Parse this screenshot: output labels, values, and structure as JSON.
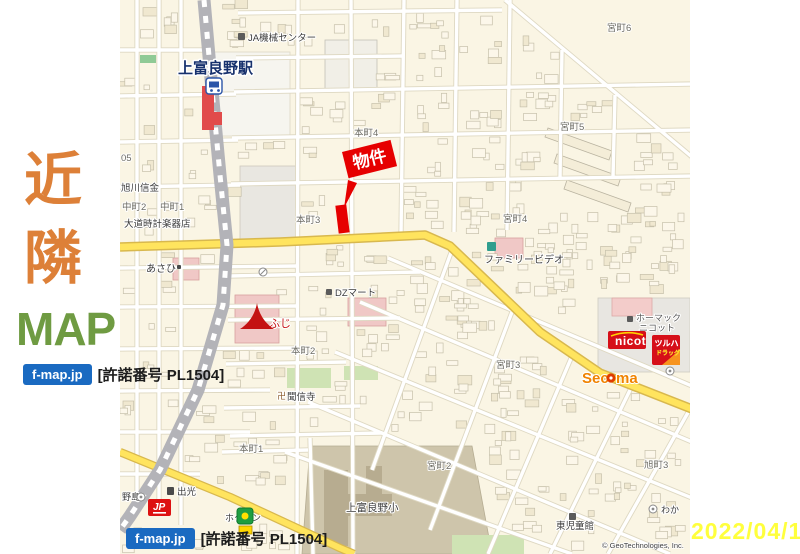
{
  "sidebar": {
    "kanji_top": "近",
    "kanji_bottom": "隣",
    "kanji_color": "#dd8038",
    "word": "MAP",
    "word_color": "#6f9b42",
    "license_badge": "f-map.jp",
    "license_text": "[許諾番号 PL1504]",
    "badge_bg": "#1a6ac1"
  },
  "footer": {
    "license_badge": "f-map.jp",
    "license_text": "[許諾番号 PL1504]"
  },
  "date_stamp": {
    "text": "2022/04/18",
    "color": "#ffff3d"
  },
  "map": {
    "bg": "#faf5e4",
    "copyright": {
      "t": "© GeoTechnologies, Inc.",
      "x": 482,
      "y": 548
    },
    "station": {
      "label": "上富良野駅",
      "x": 58,
      "y": 73,
      "color": "#17316d"
    },
    "banner": {
      "label": "物件",
      "color": "#e60000",
      "x": 222,
      "y": 152,
      "w": 50,
      "h": 27,
      "rot": -14,
      "tail": [
        [
          228,
          180
        ],
        [
          237,
          183
        ],
        [
          224,
          208
        ]
      ],
      "marker": {
        "x": 217,
        "y": 205,
        "w": 11,
        "h": 28,
        "rot": -7
      }
    },
    "roads": {
      "white": [
        [
          17,
          0,
          17,
          505
        ],
        [
          39,
          0,
          39,
          512
        ],
        [
          61,
          0,
          61,
          525
        ],
        [
          0,
          50,
          85,
          50
        ],
        [
          0,
          96,
          116,
          94
        ],
        [
          0,
          142,
          118,
          140
        ],
        [
          0,
          187,
          120,
          185
        ],
        [
          0,
          268,
          178,
          266
        ],
        [
          0,
          307,
          177,
          306
        ],
        [
          0,
          349,
          176,
          348
        ],
        [
          0,
          391,
          150,
          390
        ],
        [
          0,
          432,
          130,
          432
        ],
        [
          0,
          474,
          80,
          474
        ],
        [
          178,
          0,
          177,
          554
        ],
        [
          231,
          0,
          233,
          554
        ],
        [
          284,
          0,
          281,
          234
        ],
        [
          337,
          0,
          334,
          232
        ],
        [
          390,
          0,
          387,
          230
        ],
        [
          442,
          50,
          440,
          178
        ],
        [
          495,
          95,
          493,
          178
        ],
        [
          118,
          13,
          382,
          10
        ],
        [
          116,
          58,
          284,
          56
        ],
        [
          114,
          92,
          572,
          84
        ],
        [
          112,
          138,
          572,
          130
        ],
        [
          111,
          184,
          572,
          176
        ],
        [
          385,
          0,
          572,
          157
        ],
        [
          110,
          276,
          300,
          272
        ],
        [
          108,
          320,
          280,
          318
        ],
        [
          106,
          364,
          226,
          362
        ],
        [
          104,
          408,
          240,
          406
        ],
        [
          102,
          452,
          188,
          450
        ],
        [
          190,
          438,
          193,
          554
        ],
        [
          110,
          436,
          262,
          433
        ],
        [
          268,
          258,
          572,
          386
        ],
        [
          240,
          302,
          572,
          442
        ],
        [
          215,
          352,
          572,
          498
        ],
        [
          188,
          402,
          550,
          554
        ],
        [
          165,
          452,
          452,
          554
        ],
        [
          332,
          250,
          252,
          470
        ],
        [
          392,
          312,
          310,
          530
        ],
        [
          452,
          356,
          368,
          554
        ],
        [
          512,
          386,
          430,
          554
        ],
        [
          570,
          409,
          488,
          554
        ]
      ],
      "yellow_main": [
        [
          0,
          247
        ],
        [
          160,
          242
        ],
        [
          305,
          235
        ],
        [
          330,
          246
        ],
        [
          420,
          332
        ],
        [
          480,
          373
        ],
        [
          572,
          409
        ]
      ],
      "yellow_south": [
        [
          0,
          452
        ],
        [
          110,
          497
        ],
        [
          220,
          548
        ],
        [
          234,
          554
        ]
      ],
      "rail": [
        [
          84,
          0
        ],
        [
          92,
          90
        ],
        [
          100,
          175
        ],
        [
          107,
          245
        ],
        [
          103,
          305
        ],
        [
          78,
          390
        ],
        [
          40,
          470
        ],
        [
          10,
          516
        ],
        [
          0,
          530
        ]
      ]
    },
    "areas": [
      {
        "x": 94,
        "y": 52,
        "w": 76,
        "h": 84,
        "f": "#f6f5ef",
        "s": "#ddd8c6"
      },
      {
        "x": 120,
        "y": 166,
        "w": 58,
        "h": 74,
        "f": "#e9e7e1",
        "s": "#ccc9bd"
      },
      {
        "x": 205,
        "y": 40,
        "w": 52,
        "h": 50,
        "f": "#f1efe7",
        "s": "#c2c0b6"
      },
      {
        "pts": [
          [
            190,
            446
          ],
          [
            352,
            446
          ],
          [
            372,
            554
          ],
          [
            182,
            554
          ]
        ],
        "f": "#cec5ab",
        "s": "#b5ac92"
      },
      {
        "x": 204,
        "y": 470,
        "w": 24,
        "h": 76,
        "f": "#b7ac90"
      },
      {
        "x": 214,
        "y": 494,
        "w": 58,
        "h": 22,
        "f": "#b7ac90"
      },
      {
        "x": 246,
        "y": 466,
        "w": 16,
        "h": 36,
        "f": "#b7ac90"
      },
      {
        "x": 478,
        "y": 298,
        "w": 92,
        "h": 74,
        "f": "#e8e6e1",
        "s": "#cfccc0"
      },
      {
        "x": 492,
        "y": 298,
        "w": 40,
        "h": 18,
        "f": "#f3ccca",
        "s": "#dba8a6"
      },
      {
        "x": 332,
        "y": 535,
        "w": 72,
        "h": 19,
        "f": "#cfe3b4"
      },
      {
        "x": 167,
        "y": 368,
        "w": 44,
        "h": 20,
        "f": "#cfe3b4"
      },
      {
        "x": 224,
        "y": 366,
        "w": 34,
        "h": 14,
        "f": "#cfe3b4"
      },
      {
        "x": 20,
        "y": 55,
        "w": 16,
        "h": 8,
        "f": "#8fca96"
      },
      {
        "x": 115,
        "y": 295,
        "w": 44,
        "h": 48,
        "f": "#f0c8c6",
        "s": "#d8a09e"
      },
      {
        "x": 53,
        "y": 258,
        "w": 26,
        "h": 22,
        "f": "#f0c8c6",
        "s": "#d8a09e"
      },
      {
        "x": 228,
        "y": 298,
        "w": 38,
        "h": 28,
        "f": "#f0c8c6",
        "s": "#d8a09e"
      },
      {
        "x": 375,
        "y": 238,
        "w": 28,
        "h": 20,
        "f": "#f0c8c6",
        "s": "#d8a09e"
      },
      {
        "pts": [
          [
            428,
            128
          ],
          [
            492,
            151
          ],
          [
            489,
            160
          ],
          [
            425,
            137
          ]
        ],
        "f": "#f4edd8",
        "s": "#b9b3a0"
      },
      {
        "pts": [
          [
            437,
            154
          ],
          [
            501,
            177
          ],
          [
            498,
            186
          ],
          [
            434,
            163
          ]
        ],
        "f": "#f4edd8",
        "s": "#b9b3a0"
      },
      {
        "pts": [
          [
            447,
            180
          ],
          [
            511,
            203
          ],
          [
            508,
            212
          ],
          [
            444,
            189
          ]
        ],
        "f": "#f4edd8",
        "s": "#b9b3a0"
      }
    ],
    "labels_district": [
      {
        "t": "宮町6",
        "x": 487,
        "y": 31
      },
      {
        "t": "宮町5",
        "x": 440,
        "y": 130
      },
      {
        "t": "宮町4",
        "x": 383,
        "y": 222
      },
      {
        "t": "宮町3",
        "x": 376,
        "y": 368
      },
      {
        "t": "宮町2",
        "x": 307,
        "y": 469
      },
      {
        "t": "旭町3",
        "x": 524,
        "y": 468
      },
      {
        "t": "本町4",
        "x": 234,
        "y": 136
      },
      {
        "t": "本町3",
        "x": 176,
        "y": 223
      },
      {
        "t": "本町2",
        "x": 171,
        "y": 354
      },
      {
        "t": "本町1",
        "x": 119,
        "y": 452
      },
      {
        "t": "中町2",
        "x": 2,
        "y": 210
      },
      {
        "t": "中町1",
        "x": 40,
        "y": 210
      },
      {
        "t": "05",
        "x": 1,
        "y": 161
      }
    ],
    "labels_poi": [
      {
        "t": "JA機械センター",
        "x": 128,
        "y": 41
      },
      {
        "t": "ファミリービデオ",
        "x": 364,
        "y": 263,
        "s": 10
      },
      {
        "t": "DZマート",
        "x": 215,
        "y": 296
      },
      {
        "t": "あさひ",
        "x": 26,
        "y": 272,
        "s": 10
      },
      {
        "t": "大道時計楽器店",
        "x": 4,
        "y": 227
      },
      {
        "t": "旭川信金",
        "x": 1,
        "y": 191
      },
      {
        "t": "卍",
        "x": 157,
        "y": 399,
        "s": 9,
        "c": "#8a5a2a"
      },
      {
        "t": "聞信寺",
        "x": 167,
        "y": 400
      },
      {
        "t": "出光",
        "x": 57,
        "y": 495
      },
      {
        "t": "上富良野小",
        "x": 226,
        "y": 511,
        "s": 10.5
      },
      {
        "t": "東児童館",
        "x": 436,
        "y": 529
      },
      {
        "t": "わか",
        "x": 541,
        "y": 513,
        "s": 9
      },
      {
        "t": "野島",
        "x": 2,
        "y": 500,
        "s": 9
      },
      {
        "t": "ホクレン",
        "x": 105,
        "y": 521,
        "s": 9
      },
      {
        "t": "ホーマック",
        "x": 516,
        "y": 321,
        "s": 9,
        "c": "#5a5a5a"
      },
      {
        "t": "ニコット",
        "x": 519,
        "y": 331,
        "s": 9,
        "c": "#5a5a5a"
      },
      {
        "t": "ふじ",
        "x": 149,
        "y": 327,
        "s": 11,
        "c": "#c41212"
      }
    ],
    "icons_square": [
      {
        "x": 118,
        "y": 33,
        "w": 7,
        "h": 7,
        "f": "#5b5b5b"
      },
      {
        "x": 507,
        "y": 316,
        "w": 6,
        "h": 6,
        "f": "#5b5b5b"
      },
      {
        "x": 449,
        "y": 513,
        "w": 7,
        "h": 7,
        "f": "#5b5b5b"
      },
      {
        "x": 367,
        "y": 242,
        "w": 9,
        "h": 9,
        "f": "#2f9e8e"
      },
      {
        "x": 206,
        "y": 289,
        "w": 6,
        "h": 6,
        "f": "#5b5b5b"
      },
      {
        "x": 47,
        "y": 487,
        "w": 7,
        "h": 8,
        "f": "#4a4a4a"
      },
      {
        "x": 57,
        "y": 265,
        "w": 4,
        "h": 4,
        "f": "#4a4a4a"
      }
    ],
    "icons_circle": [
      {
        "x": 143,
        "y": 272,
        "slash": true
      },
      {
        "x": 550,
        "y": 371,
        "dot": true
      },
      {
        "x": 21,
        "y": 497,
        "dot": true
      },
      {
        "x": 533,
        "y": 509,
        "dot": true
      }
    ],
    "logos": {
      "nicot": {
        "text": "nicot",
        "x": 488,
        "y": 331,
        "w": 38,
        "h": 18,
        "bg": "#d60f18"
      },
      "tsuruha": {
        "line1": "ツルハ",
        "line2": "ドラッグ",
        "x": 532,
        "y": 335,
        "w": 28,
        "h": 30,
        "bg": "#d60f18"
      },
      "secoma": {
        "t1": "Sec",
        "t2": "ma",
        "x": 462,
        "y": 383,
        "color": "#f08300",
        "dot": "#e03c00"
      },
      "jp": {
        "text": "JP",
        "x": 28,
        "y": 499,
        "w": 23,
        "h": 17,
        "bg": "#dd1111"
      },
      "hokuren": {
        "x": 117,
        "y": 508,
        "w": 16,
        "h": 16,
        "bg": "#1e9e40",
        "sign": "#ffd700"
      },
      "fuji_icon": {
        "x": 120,
        "y": 300,
        "color": "#c41212"
      }
    }
  }
}
